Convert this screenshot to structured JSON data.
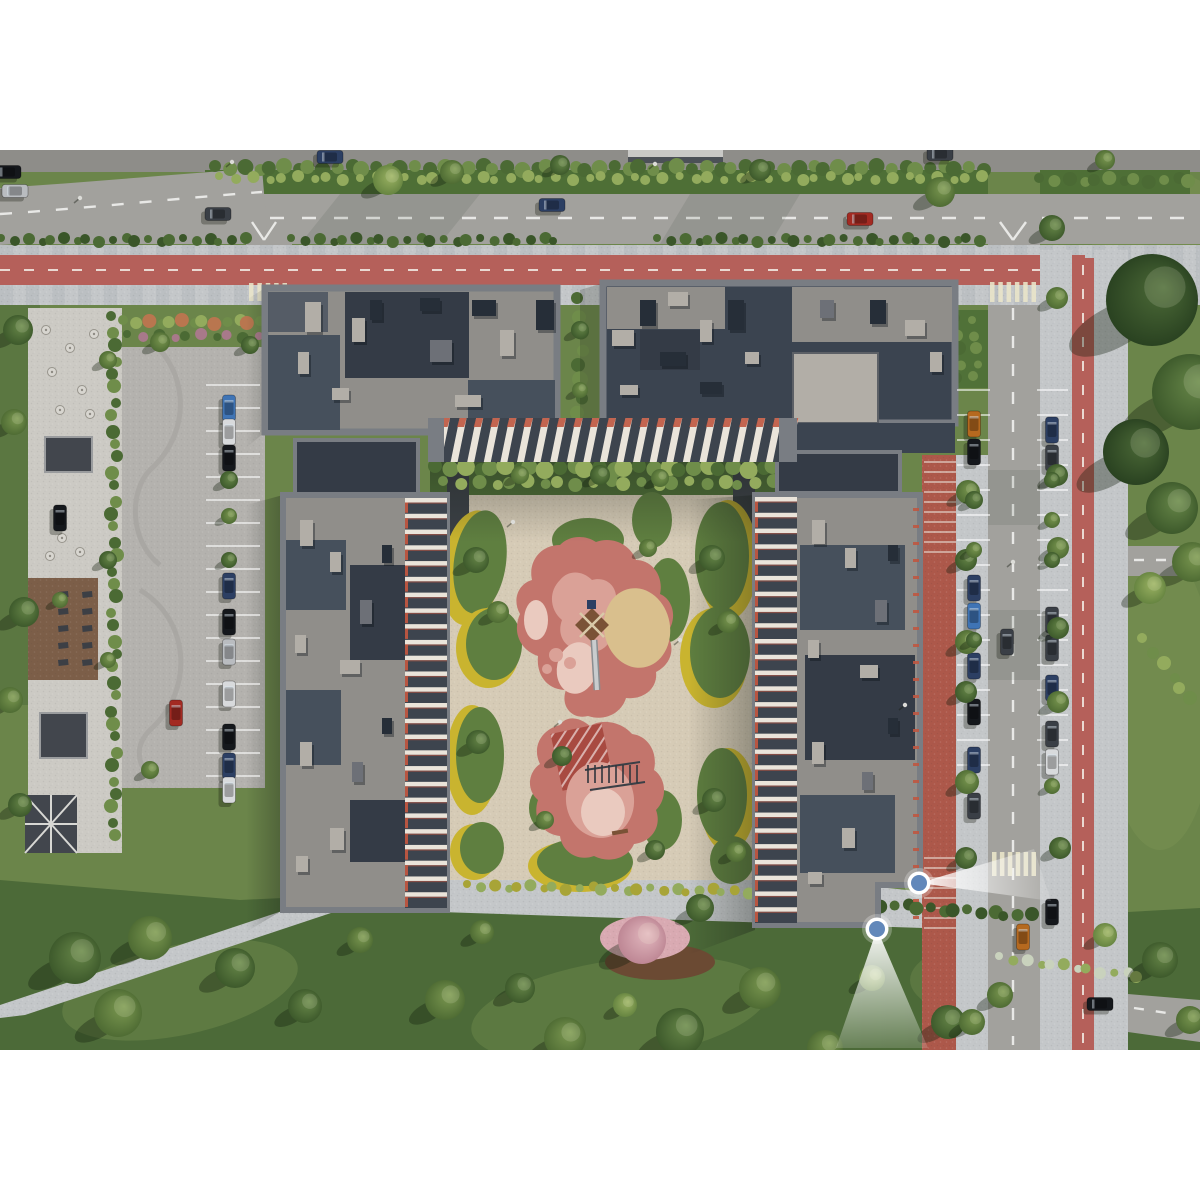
{
  "meta": {
    "description": "Aerial top-down 3D render of a residential complex masterplan: four dark-roofed apartment slabs around a landscaped courtyard with pink playground areas, surface parking, roads with red bike lanes, lawns with trees, and two blue camera viewpoint markers with white view cones at the lower right building corner",
    "canvas_width": 1200,
    "canvas_height": 1200,
    "scene": {
      "x": 0,
      "y": 150,
      "width": 1200,
      "height": 900
    }
  },
  "palette": {
    "lawn": "#6b854a",
    "lawn_dark": "#4c6a38",
    "lawn_light": "#88a05a",
    "road": "#a2a19d",
    "road_dark": "#8e8d89",
    "sidewalk": "#c4c7c9",
    "bike_lane": "#b5605a",
    "crosswalk": "#eae6c9",
    "brick": "#ad584a",
    "plaza": "#cccac4",
    "parking": "#b4b2ae",
    "deck": "#7c5e48",
    "pergola": "#42464d",
    "hedge": "#4e6f36",
    "island": "#5f7f40",
    "island_yellow": "#c9b42f",
    "paving": "#d6cbb6",
    "mulch": "#6b4a33",
    "pink": "#c3756c",
    "pink_light": "#daa197",
    "pink_pale": "#eacabf",
    "pink_red": "#a84a41",
    "sand": "#d9bf8d",
    "wood": "#7a5236",
    "roof_concrete": "#908e8a",
    "roof_navy": "#3b4450",
    "roof_dark": "#46505c",
    "roof_dark2": "#343b46",
    "parapet": "#797d83",
    "unit_light": "#b2aea7",
    "unit_dark": "#262e38",
    "unit_mid": "#6d7077",
    "stripe_light": "#eae4da",
    "stripe_dark": "#3d444e",
    "accent": "#bf5640",
    "marker_fill": "#6288ba",
    "marker_ring": "#ffffff",
    "line": "#f2f2f0"
  },
  "bush_shades": [
    "#6f8d4a",
    "#4b6a34",
    "#93ab5d",
    "#3a5629",
    "#5f7f40",
    "#b9764f",
    "#a8798a",
    "#a8a437",
    "#c9d2bd"
  ],
  "tree_shades": [
    [
      "#7d9a52",
      "#4b6831"
    ],
    [
      "#69894a",
      "#3a5629"
    ],
    [
      "#9db464",
      "#62813e"
    ],
    [
      "#4d6b38",
      "#273f1f"
    ],
    [
      "#e3b9c0",
      "#bb8391"
    ]
  ],
  "car_colors": {
    "navy": "#2c3f63",
    "black": "#15181c",
    "dark": "#3a3f46",
    "silver": "#b9bcc0",
    "white": "#d8dadc",
    "blue": "#3f74b5",
    "red": "#a32a22",
    "orange": "#b5691f"
  },
  "viewpoints": [
    {
      "id": "viewpoint-marker-1",
      "cx": 919,
      "cy": 883,
      "cone": [
        [
          1034,
          849
        ],
        [
          1051,
          901
        ]
      ]
    },
    {
      "id": "viewpoint-marker-2",
      "cx": 877,
      "cy": 929,
      "cone": [
        [
          836,
          1048
        ],
        [
          928,
          1048
        ]
      ]
    }
  ],
  "cars": [
    [
      8,
      172,
      "h",
      "black"
    ],
    [
      15,
      191,
      "h",
      "silver"
    ],
    [
      218,
      214,
      "h",
      "dark"
    ],
    [
      330,
      157,
      "h",
      "navy"
    ],
    [
      552,
      205,
      "h",
      "navy"
    ],
    [
      860,
      219,
      "h",
      "red"
    ],
    [
      940,
      154,
      "h",
      "dark"
    ],
    [
      1007,
      642,
      "v",
      "dark"
    ],
    [
      1023,
      937,
      "v",
      "orange"
    ],
    [
      1100,
      1004,
      "h",
      "black"
    ],
    [
      974,
      424,
      "v",
      "orange"
    ],
    [
      974,
      452,
      "v",
      "black"
    ],
    [
      974,
      588,
      "v",
      "navy"
    ],
    [
      974,
      616,
      "v",
      "blue"
    ],
    [
      974,
      666,
      "v",
      "navy"
    ],
    [
      974,
      712,
      "v",
      "black"
    ],
    [
      974,
      760,
      "v",
      "navy"
    ],
    [
      974,
      806,
      "v",
      "dark"
    ],
    [
      1052,
      430,
      "v",
      "navy"
    ],
    [
      1052,
      458,
      "v",
      "dark"
    ],
    [
      1052,
      620,
      "v",
      "dark"
    ],
    [
      1052,
      648,
      "v",
      "dark"
    ],
    [
      1052,
      688,
      "v",
      "navy"
    ],
    [
      1052,
      734,
      "v",
      "dark"
    ],
    [
      1052,
      762,
      "v",
      "white"
    ],
    [
      1052,
      912,
      "v",
      "black"
    ],
    [
      229,
      408,
      "v",
      "blue"
    ],
    [
      229,
      432,
      "v",
      "white"
    ],
    [
      229,
      458,
      "v",
      "black"
    ],
    [
      229,
      586,
      "v",
      "navy"
    ],
    [
      229,
      622,
      "v",
      "black"
    ],
    [
      229,
      652,
      "v",
      "silver"
    ],
    [
      229,
      694,
      "v",
      "white"
    ],
    [
      229,
      737,
      "v",
      "black"
    ],
    [
      229,
      766,
      "v",
      "navy"
    ],
    [
      229,
      790,
      "v",
      "white"
    ],
    [
      176,
      713,
      "v",
      "red"
    ],
    [
      60,
      518,
      "v",
      "black"
    ]
  ],
  "trees": [
    [
      75,
      958,
      26,
      1
    ],
    [
      150,
      938,
      22,
      0
    ],
    [
      235,
      968,
      20,
      1
    ],
    [
      118,
      1013,
      24,
      0
    ],
    [
      305,
      1006,
      17,
      1
    ],
    [
      360,
      940,
      13,
      0
    ],
    [
      445,
      1000,
      20,
      0
    ],
    [
      520,
      988,
      15,
      1
    ],
    [
      565,
      1038,
      21,
      0
    ],
    [
      625,
      1005,
      12,
      2
    ],
    [
      680,
      1032,
      24,
      1
    ],
    [
      760,
      988,
      21,
      0
    ],
    [
      825,
      1048,
      18,
      0
    ],
    [
      872,
      978,
      13,
      2
    ],
    [
      948,
      1022,
      17,
      1
    ],
    [
      700,
      908,
      14,
      1
    ],
    [
      482,
      932,
      12,
      0
    ],
    [
      1000,
      995,
      13,
      0
    ],
    [
      1160,
      960,
      18,
      1
    ],
    [
      1190,
      1020,
      14,
      0
    ],
    [
      1105,
      935,
      12,
      2
    ],
    [
      642,
      940,
      24,
      4
    ],
    [
      1152,
      300,
      46,
      3
    ],
    [
      1190,
      392,
      38,
      1
    ],
    [
      1136,
      452,
      33,
      3
    ],
    [
      1172,
      508,
      26,
      1
    ],
    [
      1192,
      562,
      20,
      0
    ],
    [
      1150,
      588,
      16,
      2
    ],
    [
      968,
      492,
      12,
      0
    ],
    [
      966,
      560,
      11,
      1
    ],
    [
      967,
      642,
      12,
      0
    ],
    [
      966,
      692,
      11,
      1
    ],
    [
      967,
      782,
      12,
      0
    ],
    [
      966,
      858,
      11,
      1
    ],
    [
      972,
      1022,
      13,
      0
    ],
    [
      1057,
      298,
      11,
      0
    ],
    [
      1057,
      475,
      11,
      1
    ],
    [
      1058,
      548,
      11,
      0
    ],
    [
      1058,
      628,
      11,
      1
    ],
    [
      1058,
      702,
      11,
      0
    ],
    [
      1060,
      848,
      11,
      1
    ],
    [
      388,
      180,
      15,
      2
    ],
    [
      452,
      172,
      12,
      0
    ],
    [
      560,
      165,
      10,
      1
    ],
    [
      760,
      170,
      11,
      1
    ],
    [
      940,
      192,
      15,
      0
    ],
    [
      1052,
      228,
      13,
      1
    ],
    [
      1105,
      160,
      10,
      0
    ],
    [
      18,
      330,
      15,
      1
    ],
    [
      14,
      422,
      13,
      0
    ],
    [
      24,
      612,
      15,
      1
    ],
    [
      10,
      700,
      13,
      0
    ],
    [
      20,
      805,
      12,
      1
    ],
    [
      160,
      342,
      10,
      0
    ],
    [
      250,
      345,
      9,
      1
    ],
    [
      229,
      480,
      9,
      1
    ],
    [
      229,
      516,
      8,
      0
    ],
    [
      229,
      560,
      8,
      1
    ],
    [
      150,
      770,
      9,
      0
    ],
    [
      974,
      500,
      9,
      1
    ],
    [
      974,
      550,
      8,
      0
    ],
    [
      974,
      640,
      8,
      1
    ],
    [
      1052,
      480,
      8,
      1
    ],
    [
      1052,
      520,
      8,
      0
    ],
    [
      1052,
      560,
      8,
      1
    ],
    [
      1052,
      786,
      8,
      0
    ],
    [
      476,
      560,
      13,
      1
    ],
    [
      498,
      612,
      11,
      0
    ],
    [
      478,
      742,
      12,
      1
    ],
    [
      712,
      558,
      13,
      1
    ],
    [
      728,
      622,
      11,
      0
    ],
    [
      714,
      800,
      12,
      1
    ],
    [
      736,
      852,
      10,
      0
    ],
    [
      562,
      756,
      10,
      1
    ],
    [
      648,
      548,
      9,
      0
    ],
    [
      600,
      475,
      10,
      1
    ],
    [
      660,
      478,
      9,
      0
    ],
    [
      520,
      475,
      9,
      0
    ],
    [
      545,
      820,
      9,
      0
    ],
    [
      655,
      850,
      10,
      1
    ],
    [
      580,
      330,
      9,
      1
    ],
    [
      580,
      390,
      8,
      0
    ],
    [
      108,
      360,
      9,
      0
    ],
    [
      108,
      560,
      9,
      1
    ],
    [
      60,
      600,
      8,
      0
    ],
    [
      108,
      660,
      8,
      0
    ]
  ],
  "roof_units": [
    [
      305,
      302,
      16,
      30,
      "l"
    ],
    [
      352,
      318,
      13,
      24,
      "l"
    ],
    [
      298,
      352,
      11,
      22,
      "l"
    ],
    [
      420,
      298,
      20,
      13,
      "d"
    ],
    [
      332,
      388,
      17,
      12,
      "l"
    ],
    [
      472,
      300,
      24,
      16,
      "d"
    ],
    [
      500,
      330,
      14,
      26,
      "l"
    ],
    [
      536,
      300,
      18,
      30,
      "d"
    ],
    [
      430,
      340,
      22,
      22,
      "m"
    ],
    [
      455,
      395,
      26,
      12,
      "l"
    ],
    [
      370,
      300,
      12,
      20,
      "d"
    ],
    [
      640,
      300,
      16,
      26,
      "d"
    ],
    [
      668,
      292,
      20,
      14,
      "l"
    ],
    [
      700,
      320,
      12,
      22,
      "l"
    ],
    [
      728,
      300,
      16,
      30,
      "d"
    ],
    [
      612,
      330,
      22,
      16,
      "l"
    ],
    [
      660,
      352,
      26,
      14,
      "d"
    ],
    [
      745,
      352,
      14,
      12,
      "l"
    ],
    [
      620,
      385,
      18,
      10,
      "l"
    ],
    [
      700,
      382,
      22,
      12,
      "d"
    ],
    [
      870,
      300,
      16,
      24,
      "d"
    ],
    [
      905,
      320,
      20,
      16,
      "l"
    ],
    [
      930,
      352,
      12,
      20,
      "l"
    ],
    [
      820,
      300,
      14,
      18,
      "m"
    ],
    [
      300,
      520,
      13,
      26,
      "l"
    ],
    [
      330,
      552,
      11,
      20,
      "l"
    ],
    [
      360,
      600,
      12,
      24,
      "m"
    ],
    [
      295,
      635,
      11,
      18,
      "l"
    ],
    [
      340,
      660,
      20,
      14,
      "l"
    ],
    [
      300,
      742,
      12,
      24,
      "l"
    ],
    [
      352,
      762,
      11,
      20,
      "m"
    ],
    [
      330,
      828,
      14,
      22,
      "l"
    ],
    [
      296,
      856,
      12,
      16,
      "l"
    ],
    [
      382,
      545,
      10,
      18,
      "d"
    ],
    [
      382,
      718,
      10,
      16,
      "d"
    ],
    [
      812,
      520,
      13,
      24,
      "l"
    ],
    [
      845,
      548,
      11,
      20,
      "l"
    ],
    [
      875,
      600,
      12,
      22,
      "m"
    ],
    [
      808,
      640,
      11,
      18,
      "l"
    ],
    [
      860,
      665,
      18,
      13,
      "l"
    ],
    [
      812,
      742,
      12,
      22,
      "l"
    ],
    [
      862,
      772,
      11,
      18,
      "m"
    ],
    [
      842,
      828,
      13,
      20,
      "l"
    ],
    [
      888,
      545,
      10,
      16,
      "d"
    ],
    [
      888,
      718,
      10,
      16,
      "d"
    ],
    [
      808,
      872,
      14,
      12,
      "l"
    ]
  ],
  "facades": [
    {
      "type": "v",
      "x": 430,
      "y": 418,
      "w": 365,
      "h": 44,
      "n": 22
    },
    {
      "type": "h",
      "x": 405,
      "y": 498,
      "w": 42,
      "h": 410,
      "n": 26,
      "accent": "left"
    },
    {
      "type": "h",
      "x": 755,
      "y": 497,
      "w": 42,
      "h": 426,
      "n": 27,
      "accent": "left"
    }
  ],
  "stalls": [
    {
      "x": 206,
      "y": 385,
      "w": 54,
      "n": 17,
      "step": 23
    },
    {
      "x": 957,
      "y": 390,
      "w": 33,
      "n": 15,
      "step": 25
    },
    {
      "x": 1037,
      "y": 390,
      "w": 31,
      "n": 15,
      "step": 25
    }
  ],
  "treads": [
    {
      "x": 924,
      "y": 462,
      "w": 32,
      "n": 10,
      "step": 10
    },
    {
      "x": 924,
      "y": 858,
      "w": 32,
      "n": 8,
      "step": 10
    }
  ],
  "red_ticks": {
    "x": 913,
    "y": 508,
    "n": 25,
    "step": 17,
    "w": 6,
    "h": 3
  },
  "crosswalks": [
    {
      "x": 249,
      "y": 283,
      "w": 38,
      "h": 18,
      "n": 5
    },
    {
      "x": 990,
      "y": 282,
      "w": 46,
      "h": 20,
      "n": 6
    },
    {
      "x": 992,
      "y": 852,
      "w": 44,
      "h": 24,
      "n": 6
    }
  ],
  "bush_rows": [
    {
      "x0": 218,
      "y0": 168,
      "x1": 983,
      "y1": 168,
      "step": 13,
      "r": 7,
      "cs": [
        1,
        0
      ]
    },
    {
      "x0": 222,
      "y0": 178,
      "x1": 983,
      "y1": 178,
      "step": 15,
      "r": 5,
      "cs": [
        2
      ]
    },
    {
      "x0": 4,
      "y0": 240,
      "x1": 244,
      "y1": 240,
      "step": 12,
      "r": 5,
      "cs": [
        1,
        3
      ]
    },
    {
      "x0": 294,
      "y0": 240,
      "x1": 556,
      "y1": 240,
      "step": 12,
      "r": 5,
      "cs": [
        1,
        3
      ]
    },
    {
      "x0": 660,
      "y0": 240,
      "x1": 980,
      "y1": 240,
      "step": 12,
      "r": 5,
      "cs": [
        1,
        3
      ]
    },
    {
      "x0": 1042,
      "y0": 180,
      "x1": 1190,
      "y1": 180,
      "step": 13,
      "r": 6,
      "cs": [
        1,
        0
      ]
    },
    {
      "x0": 438,
      "y0": 468,
      "x1": 788,
      "y1": 468,
      "step": 13,
      "r": 8,
      "cs": [
        1,
        0,
        2
      ]
    },
    {
      "x0": 446,
      "y0": 483,
      "x1": 788,
      "y1": 483,
      "step": 16,
      "r": 6,
      "cs": [
        0,
        2
      ]
    },
    {
      "x0": 126,
      "y0": 322,
      "x1": 260,
      "y1": 322,
      "step": 11,
      "r": 6,
      "cs": [
        0,
        2,
        5
      ]
    },
    {
      "x0": 130,
      "y0": 336,
      "x1": 258,
      "y1": 336,
      "step": 13,
      "r": 5,
      "cs": [
        1,
        6
      ]
    },
    {
      "x0": 114,
      "y0": 318,
      "x1": 114,
      "y1": 836,
      "step": 14,
      "r": 6,
      "cs": [
        1,
        0
      ]
    },
    {
      "x0": 470,
      "y0": 886,
      "x1": 772,
      "y1": 892,
      "step": 12,
      "r": 5,
      "cs": [
        7,
        2
      ]
    },
    {
      "x0": 782,
      "y0": 897,
      "x1": 1030,
      "y1": 916,
      "step": 12,
      "r": 6,
      "cs": [
        3,
        1
      ]
    },
    {
      "x0": 1002,
      "y0": 958,
      "x1": 1138,
      "y1": 976,
      "step": 12,
      "r": 5,
      "cs": [
        8,
        2
      ]
    },
    {
      "x0": 958,
      "y0": 320,
      "x1": 958,
      "y1": 378,
      "step": 12,
      "r": 6,
      "cs": [
        1,
        0
      ]
    },
    {
      "x0": 975,
      "y0": 322,
      "x1": 975,
      "y1": 376,
      "step": 13,
      "r": 5,
      "cs": [
        0
      ]
    },
    {
      "x0": 580,
      "y0": 300,
      "x1": 580,
      "y1": 430,
      "step": 15,
      "r": 7,
      "cs": [
        1,
        0
      ]
    },
    {
      "x0": 1145,
      "y0": 640,
      "x1": 1190,
      "y1": 700,
      "step": 14,
      "r": 6,
      "cs": [
        2,
        0
      ]
    }
  ],
  "plaza_tables": [
    [
      46,
      330
    ],
    [
      70,
      348
    ],
    [
      94,
      334
    ],
    [
      52,
      372
    ],
    [
      82,
      390
    ],
    [
      60,
      410
    ],
    [
      90,
      414
    ],
    [
      50,
      556
    ],
    [
      80,
      552
    ],
    [
      62,
      538
    ]
  ],
  "deck_seats": {
    "x": 58,
    "y": 592,
    "cols": 2,
    "rows": 5,
    "dx": 24,
    "dy": 17
  },
  "monkey_bars": {
    "x": 588,
    "y": 765,
    "n": 8,
    "step": 7,
    "len": 18
  },
  "lamps": [
    [
      655,
      164
    ],
    [
      80,
      198
    ],
    [
      232,
      162
    ],
    [
      1013,
      562
    ],
    [
      905,
      705
    ],
    [
      513,
      522
    ],
    [
      560,
      722
    ],
    [
      680,
      640
    ]
  ]
}
